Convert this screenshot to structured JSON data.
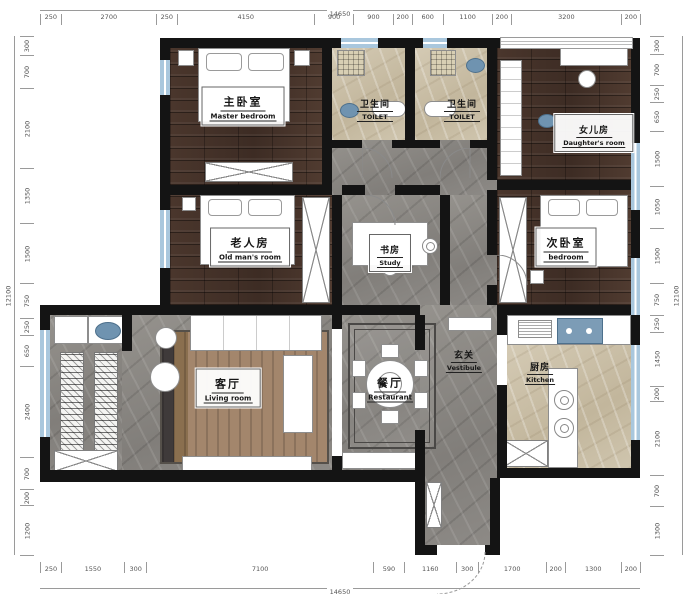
{
  "plan_title": "apartment-floor-plan",
  "rooms": {
    "master": {
      "zh": "主卧室",
      "en": "Master bedroom"
    },
    "bath1": {
      "zh": "卫生间",
      "en": "TOILET"
    },
    "bath2": {
      "zh": "卫生间",
      "en": "TOILET"
    },
    "daughter": {
      "zh": "女儿房",
      "en": "Daughter's room"
    },
    "oldman": {
      "zh": "老人房",
      "en": "Old man's room"
    },
    "study": {
      "zh": "书房",
      "en": "Study"
    },
    "second": {
      "zh": "次卧室",
      "en": "bedroom"
    },
    "living": {
      "zh": "客厅",
      "en": "Living room"
    },
    "dining": {
      "zh": "餐厅",
      "en": "Restaurant"
    },
    "vestibule": {
      "zh": "玄关",
      "en": "Vestibule"
    },
    "kitchen": {
      "zh": "厨房",
      "en": "Kitchen"
    }
  },
  "dimensions": {
    "top": {
      "total": "14650",
      "segments": [
        250,
        2700,
        250,
        4150,
        900,
        900,
        200,
        600,
        1100,
        200,
        3200,
        200
      ]
    },
    "bottom": {
      "total": "14650",
      "segments": [
        250,
        1550,
        300,
        7100,
        590,
        1160,
        300,
        1700,
        200,
        1300,
        200
      ]
    },
    "left": {
      "total": "12100",
      "segments": [
        300,
        700,
        2100,
        1350,
        1500,
        750,
        250,
        650,
        2400,
        700,
        200,
        1200
      ]
    },
    "right": {
      "total": "12100",
      "segments": [
        300,
        700,
        250,
        650,
        1500,
        1050,
        1500,
        750,
        250,
        1450,
        200,
        2100,
        700,
        1300
      ]
    }
  },
  "colors": {
    "wall": "#141414",
    "window_blue": "#a9c7dd",
    "wood_floor": "#46332a",
    "marble_gray": "#8d8a86",
    "marble_beige": "#cec4ad",
    "fixture_blue": "#6f93b0",
    "rug_tan": "#a3866c"
  }
}
